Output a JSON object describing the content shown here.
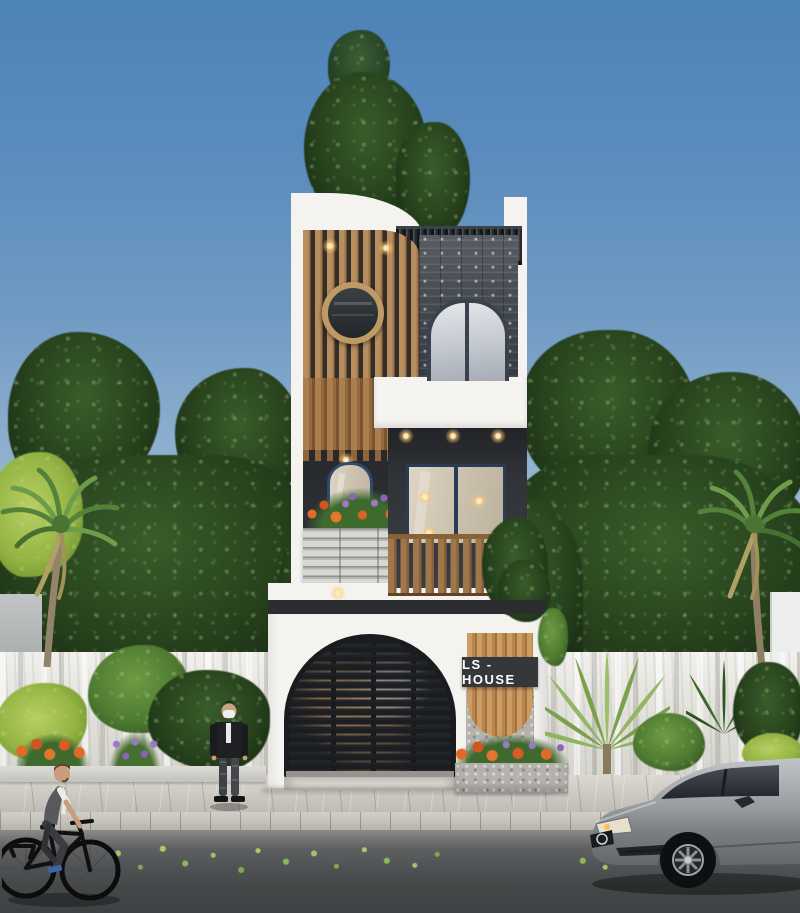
{
  "meta": {
    "description": "3D architectural exterior render: narrow three-storey modern house with wood-slat and stone facade on a tree-lined street, with cyclist, masked pedestrian and silver car"
  },
  "sign": {
    "label": "LS - HOUSE"
  },
  "scene_objects": [
    "sky",
    "background-trees",
    "rooftop-tree",
    "boundary-wall",
    "palm-trees",
    "three-storey-house",
    "wood-slat-screen",
    "round-window",
    "arched-windows",
    "louvered-pergola",
    "stone-clad-wall",
    "balcony-wood-railing",
    "flower-planters",
    "arched-louver-garage-gate",
    "house-sign-panel",
    "shrub-bed",
    "sidewalk",
    "asphalt-street",
    "fallen-leaves",
    "cyclist",
    "masked-pedestrian",
    "silver-sedan"
  ],
  "palette": {
    "sky_top": "#4e83b8",
    "sky_horizon": "#c8d7de",
    "foliage_dark": "#1c3115",
    "foliage_light": "#6f9c44",
    "facade_white": "#f4f3f0",
    "wood_slat": "#b68e60",
    "wood_deep": "#7a542e",
    "charcoal_fascia": "#2c2d2f",
    "window_frame_navy": "#2b3a55",
    "stone_gray": "#40454b",
    "boundary_wall": "#e3e1db",
    "sidewalk_gray": "#cac7c0",
    "asphalt_gray": "#454849",
    "flower_orange": "#e06a28",
    "flower_purple": "#9179c8",
    "car_silver": "#9da1a6",
    "warm_light": "#ffd9a0"
  }
}
